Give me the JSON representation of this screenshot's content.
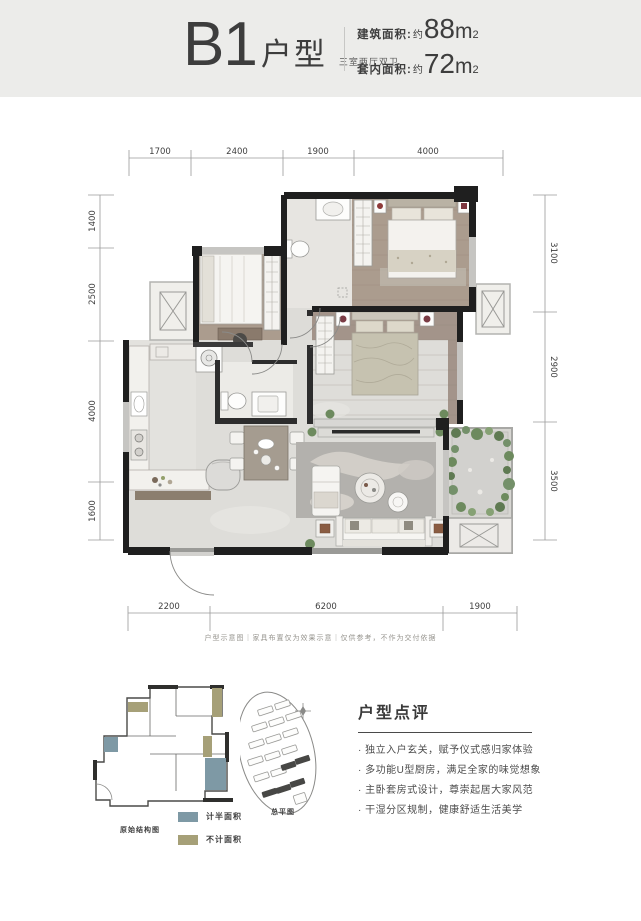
{
  "header": {
    "code": "B1",
    "type_label": "户型",
    "subtitle": "三室两厅双卫",
    "areas": [
      {
        "label": "建筑面积:",
        "approx": "约",
        "value": "88",
        "unit": "m",
        "exp": "2"
      },
      {
        "label": "套内面积:",
        "approx": "约",
        "value": "72",
        "unit": "m",
        "exp": "2"
      }
    ]
  },
  "plan": {
    "dims_top": [
      "1700",
      "2400",
      "1900",
      "4000"
    ],
    "dims_left": [
      "1400",
      "2500",
      "4000",
      "1600"
    ],
    "dims_right": [
      "3100",
      "2900",
      "3500"
    ],
    "dims_bottom": [
      "2200",
      "6200",
      "1900"
    ],
    "disclaimer": "户型示意图｜家具布置仅为效果示意｜仅供参考，不作为交付依据"
  },
  "footer": {
    "mini_plan_caption": "原始结构图",
    "site_plan_caption": "总平图",
    "legend": [
      {
        "label": "计半面积",
        "color": "#7E99A5"
      },
      {
        "label": "不计面积",
        "color": "#A6A078"
      }
    ],
    "review": {
      "title": "户型点评",
      "bullets": [
        "· 独立入户玄关，赋予仪式感归家体验",
        "· 多功能U型厨房，满足全家的味觉想象",
        "· 主卧套房式设计，尊崇起居大家风范",
        "· 干湿分区规制，健康舒适生活美学"
      ]
    }
  },
  "colors": {
    "header_bg": "#ECECEA",
    "wall_black": "#1F1F1F",
    "wood_floor": "#AB9C8E",
    "tile_floor": "#DEDDD9",
    "legend_teal": "#7E99A5",
    "legend_olive": "#A6A078",
    "plant_green": "#6D8A5E"
  }
}
